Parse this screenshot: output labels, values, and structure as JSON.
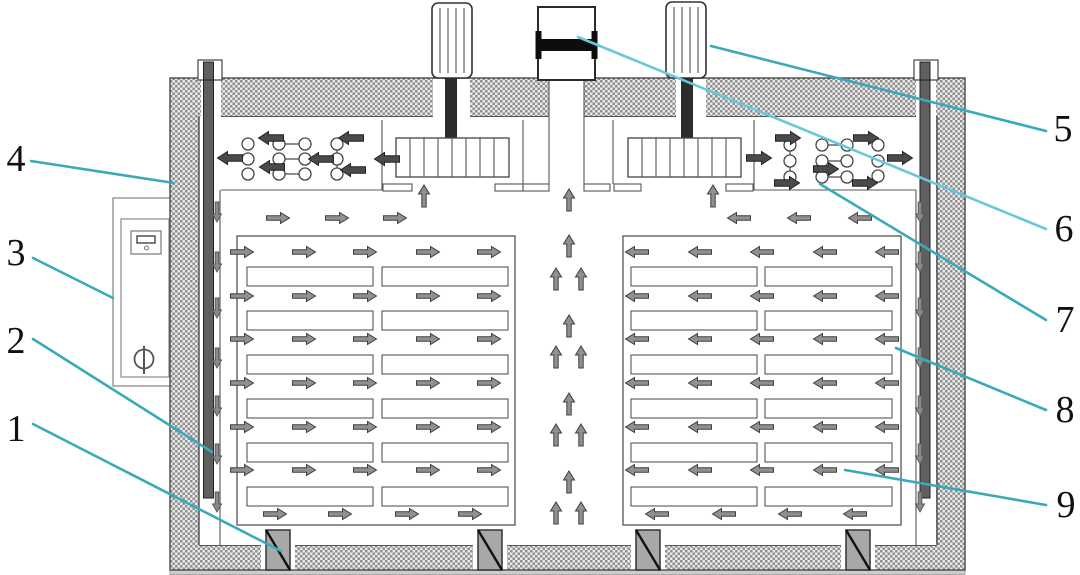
{
  "figure": {
    "type": "schematic-diagram",
    "description": "Cross-section schematic of a tray drying oven with two circulation fans, center exhaust damper, side heaters and stacked material trays",
    "background": "#ffffff"
  },
  "colors": {
    "callout_line": "#3aa9ba",
    "callout_line_light": "#68c8da",
    "outline": "#3f3f3f",
    "hatch_dot": "#8f8f8f",
    "hatch_bg": "#ebebeb",
    "arrow_fill": "#909090",
    "arrow_bold_fill": "#4a4a4a",
    "support_fill": "#a8a8a8",
    "rod_fill": "#5f5f5f"
  },
  "labels": [
    {
      "text": "1",
      "name": "floor-support-block"
    },
    {
      "text": "2",
      "name": "wall-duct-baffle-rod"
    },
    {
      "text": "3",
      "name": "control-panel"
    },
    {
      "text": "4",
      "name": "insulated-wall"
    },
    {
      "text": "5",
      "name": "fan-motor"
    },
    {
      "text": "6",
      "name": "exhaust-damper"
    },
    {
      "text": "7",
      "name": "heater-bank"
    },
    {
      "text": "8",
      "name": "hot-air-flow"
    },
    {
      "text": "9",
      "name": "material-tray"
    }
  ]
}
